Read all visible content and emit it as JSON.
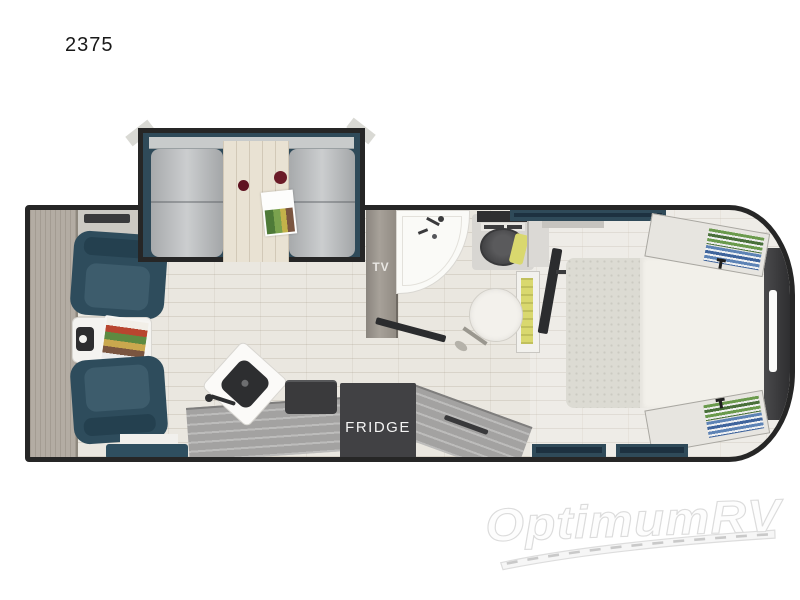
{
  "page": {
    "model_number": "2375"
  },
  "floorplan": {
    "labels": {
      "tv": "TV",
      "fridge": "FRIDGE"
    },
    "colors": {
      "wall": "#262626",
      "slide_navy": "#2f4a59",
      "chair_navy": "#2e4c5c",
      "seat_gray": "#babdbf",
      "floor": "#eae7e0",
      "wood": "#b3aca3",
      "counter_gray": "#a3a2a1",
      "appliance_dark": "#3a3a3c",
      "bed_white": "#f2f0ea",
      "blanket_gray": "#dcdbd3",
      "accent_yellow": "#d9d86e",
      "table_wood": "#e9e2d3"
    }
  },
  "watermark": {
    "brand": "OptimumRV"
  }
}
